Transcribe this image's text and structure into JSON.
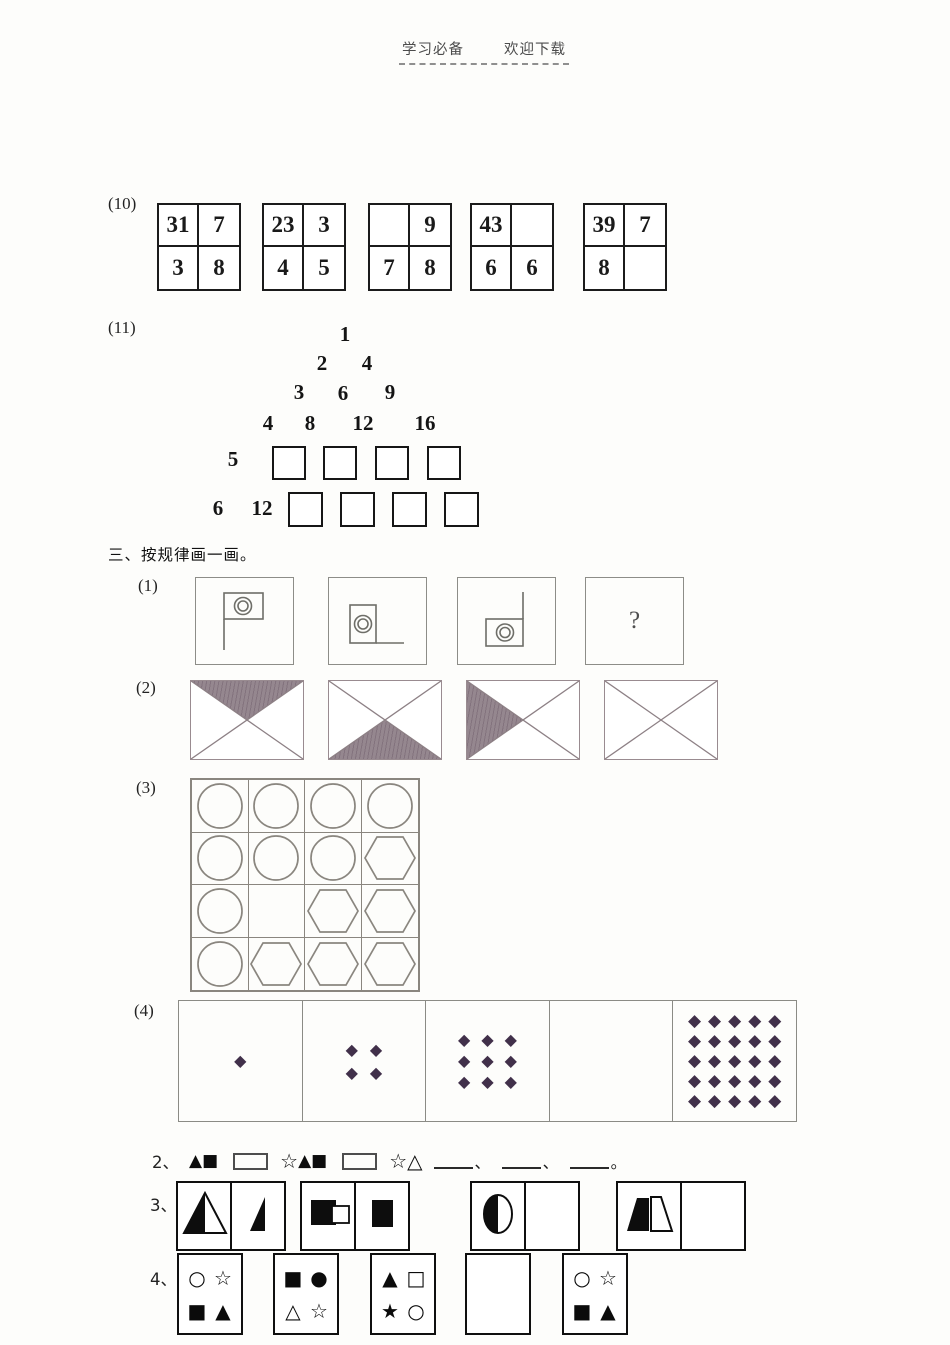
{
  "header": {
    "left": "学习必备",
    "right": "欢迎下载"
  },
  "q10": {
    "label": "(10)",
    "grids": [
      [
        "31",
        "7",
        "3",
        "8"
      ],
      [
        "23",
        "3",
        "4",
        "5"
      ],
      [
        "",
        "9",
        "7",
        "8"
      ],
      [
        "43",
        "",
        "6",
        "6"
      ],
      [
        "39",
        "7",
        "8",
        ""
      ]
    ]
  },
  "q11": {
    "label": "(11)",
    "rows": [
      [
        "1"
      ],
      [
        "2",
        "4"
      ],
      [
        "3",
        "6",
        "9"
      ],
      [
        "4",
        "8",
        "12",
        "16"
      ],
      [
        "5"
      ],
      [
        "6",
        "12"
      ]
    ]
  },
  "s3": {
    "title": "三、按规律画一画。",
    "i1": {
      "label": "(1)",
      "question_mark": "?"
    },
    "i2": {
      "label": "(2)",
      "shaded": [
        "top",
        "bottom",
        "left",
        "none"
      ]
    },
    "i3": {
      "label": "(3)",
      "grid": [
        "circle",
        "circle",
        "circle",
        "circle",
        "circle",
        "circle",
        "circle",
        "hexagon",
        "circle",
        "blank",
        "hexagon",
        "hexagon",
        "circle",
        "hexagon",
        "hexagon",
        "hexagon"
      ]
    },
    "i4": {
      "label": "(4)",
      "counts": [
        1,
        4,
        9,
        0,
        25
      ],
      "diamond": "◆"
    }
  },
  "q2": {
    "label": "2、",
    "t1": "▲",
    "t2": "■",
    "t3": "☆",
    "t4": "▲",
    "t5": "■",
    "t6": "☆",
    "t7": "△",
    "sep": "、",
    "end": "。"
  },
  "q3": {
    "label": "3、"
  },
  "q4": {
    "label": "4、",
    "boxes": [
      [
        "○",
        "☆",
        "■",
        "▲"
      ],
      [
        "■",
        "●",
        "△",
        "☆"
      ],
      [
        "▲",
        "□",
        "★",
        "○"
      ],
      [
        "",
        "",
        "",
        ""
      ],
      [
        "○",
        "☆",
        "■",
        "▲"
      ]
    ]
  },
  "colors": {
    "diamond": "#41304a",
    "shade_hatch": "#8d7e89"
  }
}
